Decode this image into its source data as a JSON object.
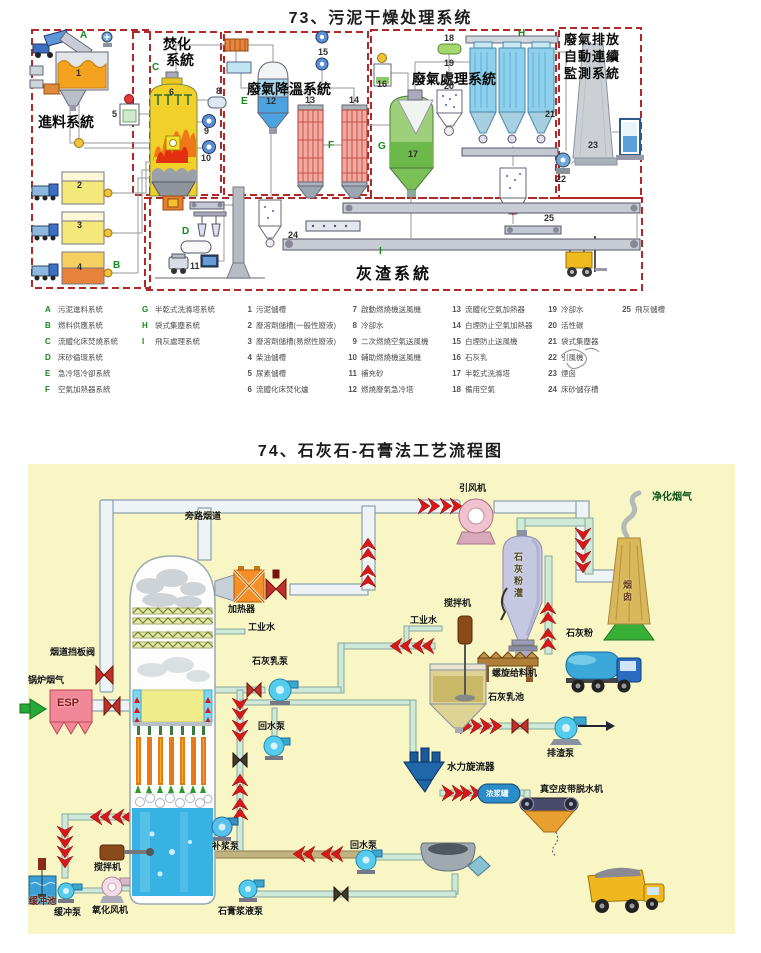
{
  "page": {
    "title_73": "73、污泥干燥处理系统",
    "title_74": "74、石灰石-石膏法工艺流程图"
  },
  "d73": {
    "sections": {
      "feed": "進料系統",
      "incineration_l1": "焚化",
      "incineration_l2": "系統",
      "cooling": "廢氣降溫系統",
      "treatment": "廢氣處理系統",
      "monitoring_l1": "廢氣排放",
      "monitoring_l2": "自動連續",
      "monitoring_l3": "監測系統",
      "ash": "灰渣系統"
    }
  },
  "legend73": {
    "systems": [
      {
        "k": "A",
        "v": "污泥進料系統"
      },
      {
        "k": "B",
        "v": "燃料供應系統"
      },
      {
        "k": "C",
        "v": "流體化床焚燒系統"
      },
      {
        "k": "D",
        "v": "床砂循環系統"
      },
      {
        "k": "E",
        "v": "急冷塔冷卻系統"
      },
      {
        "k": "F",
        "v": "空氣加熱器系統"
      },
      {
        "k": "G",
        "v": "半乾式洗滌塔系統"
      },
      {
        "k": "H",
        "v": "袋式集塵系統"
      },
      {
        "k": "I",
        "v": "飛灰處理系統"
      }
    ],
    "items": [
      {
        "k": "1",
        "v": "污泥儲槽"
      },
      {
        "k": "2",
        "v": "廢溶劑儲槽(一般性廢液)"
      },
      {
        "k": "3",
        "v": "廢溶劑儲槽(易燃性廢液)"
      },
      {
        "k": "4",
        "v": "柴油儲槽"
      },
      {
        "k": "5",
        "v": "尿素儲槽"
      },
      {
        "k": "6",
        "v": "流體化床焚化爐"
      },
      {
        "k": "7",
        "v": "啟動燃燒機送風機"
      },
      {
        "k": "8",
        "v": "冷卻水"
      },
      {
        "k": "9",
        "v": "二次燃燒空氣送風機"
      },
      {
        "k": "10",
        "v": "輔助燃燒機送風機"
      },
      {
        "k": "11",
        "v": "補充砂"
      },
      {
        "k": "12",
        "v": "燃燒廢氣急冷塔"
      },
      {
        "k": "13",
        "v": "流體化空氣加熱器"
      },
      {
        "k": "14",
        "v": "白煙防止空氣加熱器"
      },
      {
        "k": "15",
        "v": "白煙防止送風機"
      },
      {
        "k": "16",
        "v": "石灰乳"
      },
      {
        "k": "17",
        "v": "半乾式洗滌塔"
      },
      {
        "k": "18",
        "v": "備用空氣"
      },
      {
        "k": "19",
        "v": "冷卻水"
      },
      {
        "k": "20",
        "v": "活性碳"
      },
      {
        "k": "21",
        "v": "袋式集塵器"
      },
      {
        "k": "22",
        "v": "引風機"
      },
      {
        "k": "23",
        "v": "煙囪"
      },
      {
        "k": "24",
        "v": "床砂儲存槽"
      },
      {
        "k": "25",
        "v": "飛灰儲槽"
      }
    ]
  },
  "d74": {
    "labels": {
      "id_fan": "引风机",
      "clean_gas": "净化烟气",
      "bypass_duct": "旁路烟道",
      "heater": "加热器",
      "industrial_water_1": "工业水",
      "industrial_water_2": "工业水",
      "agitator_1": "搅拌机",
      "damper_valve": "烟道挡板阀",
      "boiler_gas": "锅炉烟气",
      "esp": "ESP",
      "lime_milk_pump": "石灰乳泵",
      "lime_silo": "石灰粉灌",
      "stack": "烟囱",
      "lime_powder": "石灰粉",
      "screw_feeder": "螺旋给料机",
      "lime_milk_pool": "石灰乳池",
      "slag_pump": "排渣泵",
      "hydrocyclone": "水力旋流器",
      "slurry_tank": "浓浆罐",
      "vacuum_belt": "真空皮带脱水机",
      "return_pump_1": "回水泵",
      "makeup_pump": "补浆泵",
      "agitator_2": "搅拌机",
      "oxidation_fan": "氧化风机",
      "buffer_pool": "缓冲池",
      "buffer_pump": "缓冲泵",
      "gypsum_slurry_pump": "石膏浆液泵",
      "return_pump_2": "回水泵"
    }
  }
}
